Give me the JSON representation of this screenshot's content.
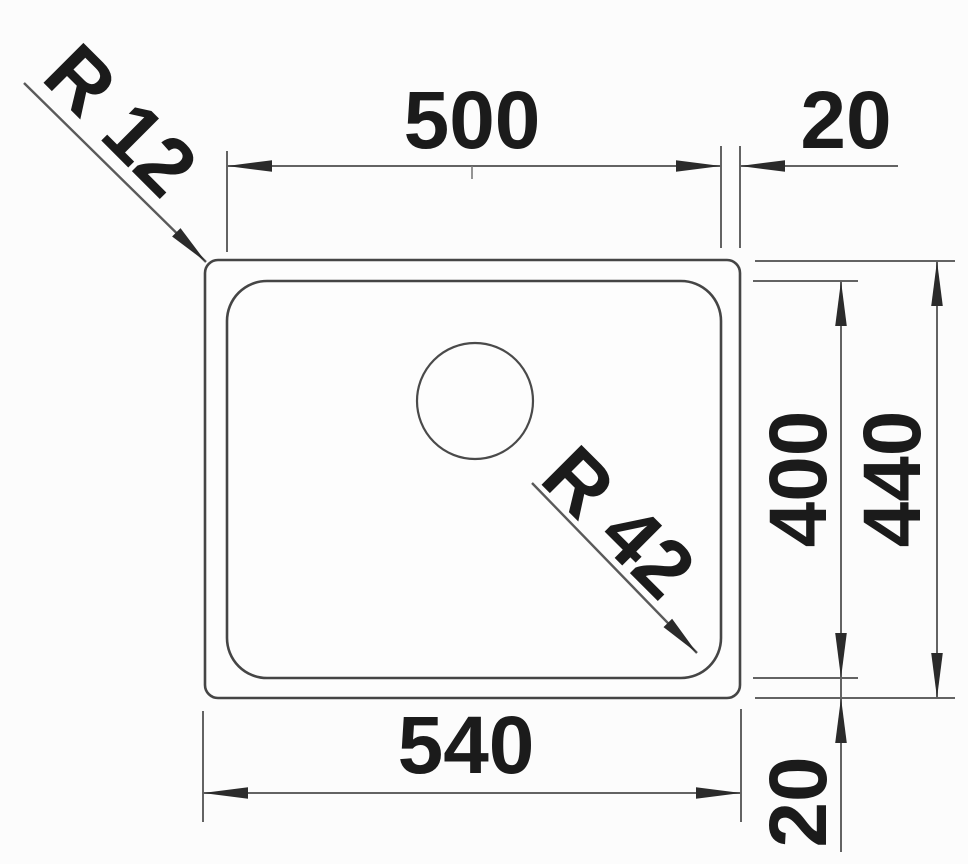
{
  "drawing": {
    "description": "Technical dimension drawing, top view of rectangular sink bowl with drain hole",
    "labels": {
      "width_inner": "500",
      "rim_top_right": "20",
      "height_inner": "400",
      "height_outer": "440",
      "width_outer": "540",
      "rim_bottom_right": "20",
      "radius_outer_corner": "R 12",
      "radius_inner_corner": "R 42"
    },
    "colors": {
      "outline": "#454545",
      "dimension_line": "#636363",
      "arrow": "#2b2b2b",
      "text": "#1b1b1b",
      "background": "#fcfcfc"
    }
  }
}
